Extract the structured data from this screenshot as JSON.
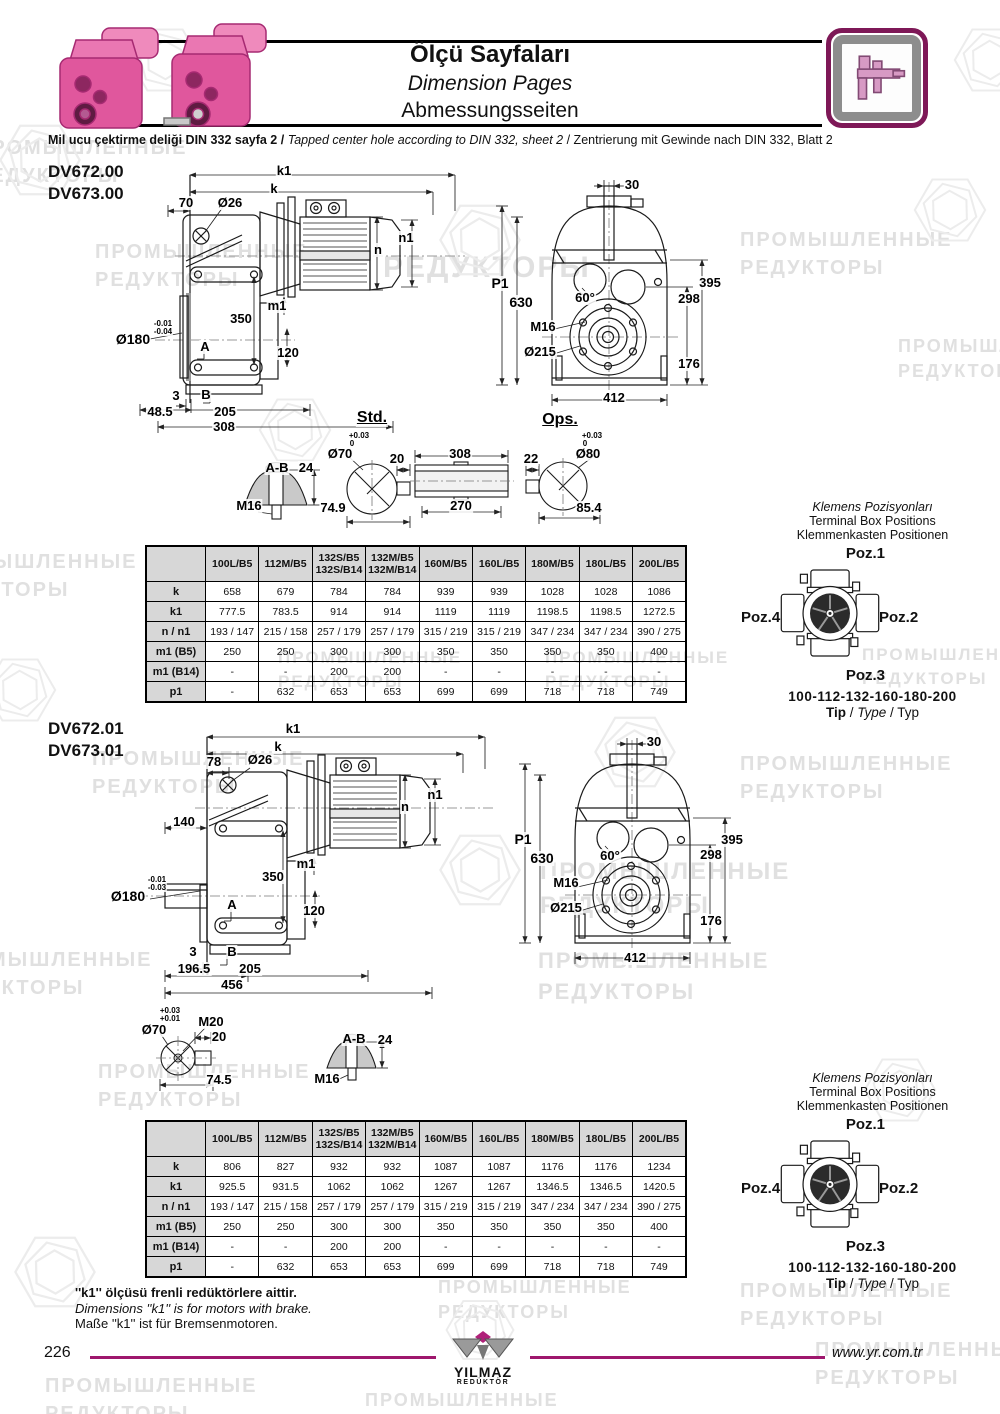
{
  "header": {
    "title_tr": "Ölçü Sayfaları",
    "title_en": "Dimension Pages",
    "title_de": "Abmessungsseiten",
    "subtitle_tr": "Mil ucu çektirme deliği DIN 332 sayfa 2 /",
    "subtitle_en": "Tapped center hole according to DIN 332, sheet 2",
    "subtitle_de": "/  Zentrierung mit Gewinde nach DIN 332, Blatt 2",
    "icon": "caliper-icon",
    "accent_color": "#9e176d"
  },
  "sections": [
    {
      "models": [
        "DV672.00",
        "DV673.00"
      ],
      "std_label": "Std.",
      "ops_label": "Ops.",
      "table": {
        "columns": [
          "100L/B5",
          "112M/B5",
          "132S/B5\n132S/B14",
          "132M/B5\n132M/B14",
          "160M/B5",
          "160L/B5",
          "180M/B5",
          "180L/B5",
          "200L/B5"
        ],
        "rows": [
          {
            "label": "k",
            "values": [
              "658",
              "679",
              "784",
              "784",
              "939",
              "939",
              "1028",
              "1028",
              "1086"
            ]
          },
          {
            "label": "k1",
            "values": [
              "777.5",
              "783.5",
              "914",
              "914",
              "1119",
              "1119",
              "1198.5",
              "1198.5",
              "1272.5"
            ]
          },
          {
            "label": "n / n1",
            "values": [
              "193 / 147",
              "215 / 158",
              "257 / 179",
              "257 / 179",
              "315 / 219",
              "315 / 219",
              "347 / 234",
              "347 / 234",
              "390 / 275"
            ]
          },
          {
            "label": "m1 (B5)",
            "values": [
              "250",
              "250",
              "300",
              "300",
              "350",
              "350",
              "350",
              "350",
              "400"
            ]
          },
          {
            "label": "m1 (B14)",
            "values": [
              "-",
              "-",
              "200",
              "200",
              "-",
              "-",
              "-",
              "-",
              "-"
            ]
          },
          {
            "label": "p1",
            "values": [
              "-",
              "632",
              "653",
              "653",
              "699",
              "699",
              "718",
              "718",
              "749"
            ]
          }
        ]
      },
      "terminal": {
        "heading_tr": "Klemens Pozisyonları",
        "heading_en": "Terminal Box Positions",
        "heading_de": "Klemmenkasten Positionen",
        "poz1": "Poz.1",
        "poz2": "Poz.2",
        "poz3": "Poz.3",
        "poz4": "Poz.4",
        "type_range": "100-112-132-160-180-200",
        "tip_tr": "Tip",
        "tip_en": "Type",
        "tip_de": "Typ"
      }
    },
    {
      "models": [
        "DV672.01",
        "DV673.01"
      ],
      "table": {
        "columns": [
          "100L/B5",
          "112M/B5",
          "132S/B5\n132S/B14",
          "132M/B5\n132M/B14",
          "160M/B5",
          "160L/B5",
          "180M/B5",
          "180L/B5",
          "200L/B5"
        ],
        "rows": [
          {
            "label": "k",
            "values": [
              "806",
              "827",
              "932",
              "932",
              "1087",
              "1087",
              "1176",
              "1176",
              "1234"
            ]
          },
          {
            "label": "k1",
            "values": [
              "925.5",
              "931.5",
              "1062",
              "1062",
              "1267",
              "1267",
              "1346.5",
              "1346.5",
              "1420.5"
            ]
          },
          {
            "label": "n / n1",
            "values": [
              "193 / 147",
              "215 / 158",
              "257 / 179",
              "257 / 179",
              "315 / 219",
              "315 / 219",
              "347 / 234",
              "347 / 234",
              "390 / 275"
            ]
          },
          {
            "label": "m1 (B5)",
            "values": [
              "250",
              "250",
              "300",
              "300",
              "350",
              "350",
              "350",
              "350",
              "400"
            ]
          },
          {
            "label": "m1 (B14)",
            "values": [
              "-",
              "-",
              "200",
              "200",
              "-",
              "-",
              "-",
              "-",
              "-"
            ]
          },
          {
            "label": "p1",
            "values": [
              "-",
              "632",
              "653",
              "653",
              "699",
              "699",
              "718",
              "718",
              "749"
            ]
          }
        ]
      },
      "terminal": {
        "heading_tr": "Klemens Pozisyonları",
        "heading_en": "Terminal Box Positions",
        "heading_de": "Klemmenkasten Positionen",
        "poz1": "Poz.1",
        "poz2": "Poz.2",
        "poz3": "Poz.3",
        "poz4": "Poz.4",
        "type_range": "100-112-132-160-180-200",
        "tip_tr": "Tip",
        "tip_en": "Type",
        "tip_de": "Typ"
      }
    }
  ],
  "labels": [
    {
      "t": "k1",
      "x": 284,
      "y": 164
    },
    {
      "t": "k",
      "x": 274,
      "y": 182
    },
    {
      "t": "70",
      "x": 186,
      "y": 196
    },
    {
      "t": "Ø26",
      "x": 230,
      "y": 196
    },
    {
      "t": "n1",
      "x": 406,
      "y": 231
    },
    {
      "t": "n",
      "x": 378,
      "y": 243
    },
    {
      "t": "m1",
      "x": 277,
      "y": 299
    },
    {
      "t": "350",
      "x": 241,
      "y": 312
    },
    {
      "t": "Ø180",
      "x": 133,
      "y": 332,
      "s": 14
    },
    {
      "t": "-0.01",
      "x": 163,
      "y": 320,
      "s": 8
    },
    {
      "t": "-0.04",
      "x": 163,
      "y": 328,
      "s": 8
    },
    {
      "t": "A",
      "x": 205,
      "y": 340
    },
    {
      "t": "120",
      "x": 288,
      "y": 346
    },
    {
      "t": "3",
      "x": 176,
      "y": 389
    },
    {
      "t": "B",
      "x": 206,
      "y": 388
    },
    {
      "t": "48.5",
      "x": 160,
      "y": 405
    },
    {
      "t": "205",
      "x": 225,
      "y": 405
    },
    {
      "t": "308",
      "x": 224,
      "y": 420
    },
    {
      "t": "Std.",
      "x": 372,
      "y": 410,
      "s": 16,
      "u": 1
    },
    {
      "t": "30",
      "x": 632,
      "y": 178
    },
    {
      "t": "P1",
      "x": 500,
      "y": 276,
      "s": 14
    },
    {
      "t": "630",
      "x": 521,
      "y": 295,
      "s": 14
    },
    {
      "t": "M16",
      "x": 543,
      "y": 320
    },
    {
      "t": "Ø215",
      "x": 540,
      "y": 345
    },
    {
      "t": "60°",
      "x": 585,
      "y": 291
    },
    {
      "t": "395",
      "x": 710,
      "y": 276
    },
    {
      "t": "298",
      "x": 689,
      "y": 292
    },
    {
      "t": "176",
      "x": 689,
      "y": 357
    },
    {
      "t": "412",
      "x": 614,
      "y": 391
    },
    {
      "t": "Ops.",
      "x": 560,
      "y": 412,
      "s": 16,
      "u": 1
    },
    {
      "t": "A-B",
      "x": 277,
      "y": 461
    },
    {
      "t": "24",
      "x": 306,
      "y": 461
    },
    {
      "t": "M16",
      "x": 249,
      "y": 499
    },
    {
      "t": "+0.03",
      "x": 359,
      "y": 432,
      "s": 8
    },
    {
      "t": "0",
      "x": 352,
      "y": 440,
      "s": 8
    },
    {
      "t": "Ø70",
      "x": 340,
      "y": 447
    },
    {
      "t": "20",
      "x": 397,
      "y": 452
    },
    {
      "t": "74.9",
      "x": 333,
      "y": 501
    },
    {
      "t": "308",
      "x": 460,
      "y": 447
    },
    {
      "t": "270",
      "x": 461,
      "y": 499
    },
    {
      "t": "22",
      "x": 531,
      "y": 452
    },
    {
      "t": "+0.03",
      "x": 592,
      "y": 432,
      "s": 8
    },
    {
      "t": "0",
      "x": 585,
      "y": 440,
      "s": 8
    },
    {
      "t": "Ø80",
      "x": 588,
      "y": 447
    },
    {
      "t": "85.4",
      "x": 589,
      "y": 501
    },
    {
      "t": "k1",
      "x": 293,
      "y": 722
    },
    {
      "t": "k",
      "x": 278,
      "y": 740
    },
    {
      "t": "78",
      "x": 214,
      "y": 755
    },
    {
      "t": "Ø26",
      "x": 260,
      "y": 753
    },
    {
      "t": "n1",
      "x": 435,
      "y": 788
    },
    {
      "t": "n",
      "x": 405,
      "y": 800
    },
    {
      "t": "140",
      "x": 184,
      "y": 815
    },
    {
      "t": "m1",
      "x": 306,
      "y": 857
    },
    {
      "t": "350",
      "x": 273,
      "y": 870
    },
    {
      "t": "Ø180",
      "x": 128,
      "y": 889,
      "s": 14
    },
    {
      "t": "-0.01",
      "x": 157,
      "y": 876,
      "s": 8
    },
    {
      "t": "-0.03",
      "x": 157,
      "y": 884,
      "s": 8
    },
    {
      "t": "A",
      "x": 232,
      "y": 898
    },
    {
      "t": "120",
      "x": 314,
      "y": 904
    },
    {
      "t": "3",
      "x": 193,
      "y": 945
    },
    {
      "t": "B",
      "x": 232,
      "y": 945
    },
    {
      "t": "196.5",
      "x": 194,
      "y": 962
    },
    {
      "t": "205",
      "x": 250,
      "y": 962
    },
    {
      "t": "456",
      "x": 232,
      "y": 978
    },
    {
      "t": "30",
      "x": 654,
      "y": 735
    },
    {
      "t": "P1",
      "x": 523,
      "y": 832,
      "s": 14
    },
    {
      "t": "630",
      "x": 542,
      "y": 851,
      "s": 14
    },
    {
      "t": "60°",
      "x": 610,
      "y": 849
    },
    {
      "t": "M16",
      "x": 566,
      "y": 876
    },
    {
      "t": "Ø215",
      "x": 566,
      "y": 901
    },
    {
      "t": "395",
      "x": 732,
      "y": 833
    },
    {
      "t": "298",
      "x": 711,
      "y": 848
    },
    {
      "t": "176",
      "x": 711,
      "y": 914
    },
    {
      "t": "412",
      "x": 635,
      "y": 951
    },
    {
      "t": "+0.03",
      "x": 170,
      "y": 1007,
      "s": 8
    },
    {
      "t": "+0.01",
      "x": 170,
      "y": 1015,
      "s": 8
    },
    {
      "t": "Ø70",
      "x": 154,
      "y": 1023
    },
    {
      "t": "M20",
      "x": 211,
      "y": 1015
    },
    {
      "t": "20",
      "x": 219,
      "y": 1030
    },
    {
      "t": "74.5",
      "x": 219,
      "y": 1073
    },
    {
      "t": "A-B",
      "x": 354,
      "y": 1032
    },
    {
      "t": "24",
      "x": 385,
      "y": 1033
    },
    {
      "t": "M16",
      "x": 327,
      "y": 1072
    }
  ],
  "watermarks": {
    "texts": [
      {
        "x": -25,
        "y": 134,
        "s": 20,
        "l": [
          "ПРОМЫШЛЕННЫЕ",
          "РЕДУКТОРЫ"
        ]
      },
      {
        "x": 95,
        "y": 238,
        "s": 20,
        "l": [
          "ПРОМЫШЛЕННЫЕ",
          "РЕДУКТОРЫ"
        ]
      },
      {
        "x": 383,
        "y": 247,
        "s": 30,
        "l": [
          "РЕДУКТОРЫ"
        ]
      },
      {
        "x": 740,
        "y": 226,
        "s": 20,
        "l": [
          "ПРОМЫШЛЕННЫЕ",
          "РЕДУКТОРЫ"
        ]
      },
      {
        "x": 898,
        "y": 334,
        "s": 18,
        "l": [
          "ПРОМЫШЛЕННЫЕ",
          "РЕДУКТОРЫ"
        ]
      },
      {
        "x": -75,
        "y": 548,
        "s": 20,
        "l": [
          "ПРОМЫШЛЕННЫЕ",
          "РЕДУКТОРЫ"
        ]
      },
      {
        "x": 278,
        "y": 646,
        "s": 17,
        "l": [
          "ПРОМЫШЛЕННЫЕ",
          "РЕДУКТОРЫ"
        ]
      },
      {
        "x": 545,
        "y": 646,
        "s": 17,
        "l": [
          "ПРОМЫШЛЕННЫЕ",
          "РЕДУКТОРЫ"
        ]
      },
      {
        "x": 862,
        "y": 643,
        "s": 17,
        "l": [
          "ПРОМЫШЛЕННЫЕ",
          "РЕДУКТОРЫ"
        ]
      },
      {
        "x": 92,
        "y": 745,
        "s": 20,
        "l": [
          "ПРОМЫШЛЕННЫЕ",
          "РЕДУКТОРЫ"
        ]
      },
      {
        "x": 740,
        "y": 750,
        "s": 20,
        "l": [
          "ПРОМЫШЛЕННЫЕ",
          "РЕДУКТОРЫ"
        ]
      },
      {
        "x": 540,
        "y": 855,
        "s": 24,
        "l": [
          "ПРОМЫШЛЕННЫЕ",
          "РЕДУКТОРЫ"
        ]
      },
      {
        "x": -60,
        "y": 946,
        "s": 20,
        "l": [
          "ПРОМЫШЛЕННЫЕ",
          "РЕДУКТОРЫ"
        ]
      },
      {
        "x": 538,
        "y": 946,
        "s": 22,
        "l": [
          "ПРОМЫШЛЕННЫЕ",
          "РЕДУКТОРЫ"
        ]
      },
      {
        "x": 98,
        "y": 1058,
        "s": 20,
        "l": [
          "ПРОМЫШЛЕННЫЕ",
          "РЕДУКТОРЫ"
        ]
      },
      {
        "x": 438,
        "y": 1275,
        "s": 18,
        "l": [
          "ПРОМЫШЛЕННЫЕ",
          "РЕДУКТОРЫ"
        ]
      },
      {
        "x": 740,
        "y": 1277,
        "s": 20,
        "l": [
          "ПРОМЫШЛЕННЫЕ",
          "РЕДУКТОРЫ"
        ]
      },
      {
        "x": 45,
        "y": 1372,
        "s": 20,
        "l": [
          "ПРОМЫШЛЕННЫЕ",
          "РЕДУКТОРЫ"
        ]
      },
      {
        "x": 365,
        "y": 1388,
        "s": 18,
        "l": [
          "ПРОМЫШЛЕННЫЕ",
          "РЕДУКТОРЫ"
        ]
      },
      {
        "x": 815,
        "y": 1336,
        "s": 20,
        "l": [
          "ПРОМЫШЛЕННЫЕ",
          "РЕДУКТОРЫ"
        ]
      }
    ],
    "hexes": [
      {
        "x": 40,
        "y": 160,
        "r": 45
      },
      {
        "x": 165,
        "y": 60,
        "r": 40
      },
      {
        "x": 480,
        "y": 240,
        "r": 45
      },
      {
        "x": 950,
        "y": 210,
        "r": 40
      },
      {
        "x": 295,
        "y": 430,
        "r": 40
      },
      {
        "x": 20,
        "y": 690,
        "r": 40
      },
      {
        "x": 635,
        "y": 752,
        "r": 45
      },
      {
        "x": 480,
        "y": 870,
        "r": 45
      },
      {
        "x": 55,
        "y": 1272,
        "r": 45
      },
      {
        "x": 900,
        "y": 1090,
        "r": 40
      },
      {
        "x": 480,
        "y": 1330,
        "r": 38
      },
      {
        "x": 990,
        "y": 60,
        "r": 40
      }
    ]
  },
  "footnote": {
    "tr": "''k1'' ölçüsü frenli redüktörlere aittir.",
    "en": "Dimensions ''k1'' is for motors with brake.",
    "de": "Maße ''k1'' ist für Bremsenmotoren."
  },
  "footer": {
    "page_number": "226",
    "website": "www.yr.com.tr",
    "brand_name": "YILMAZ",
    "brand_sub": "REDÜKTÖR"
  }
}
